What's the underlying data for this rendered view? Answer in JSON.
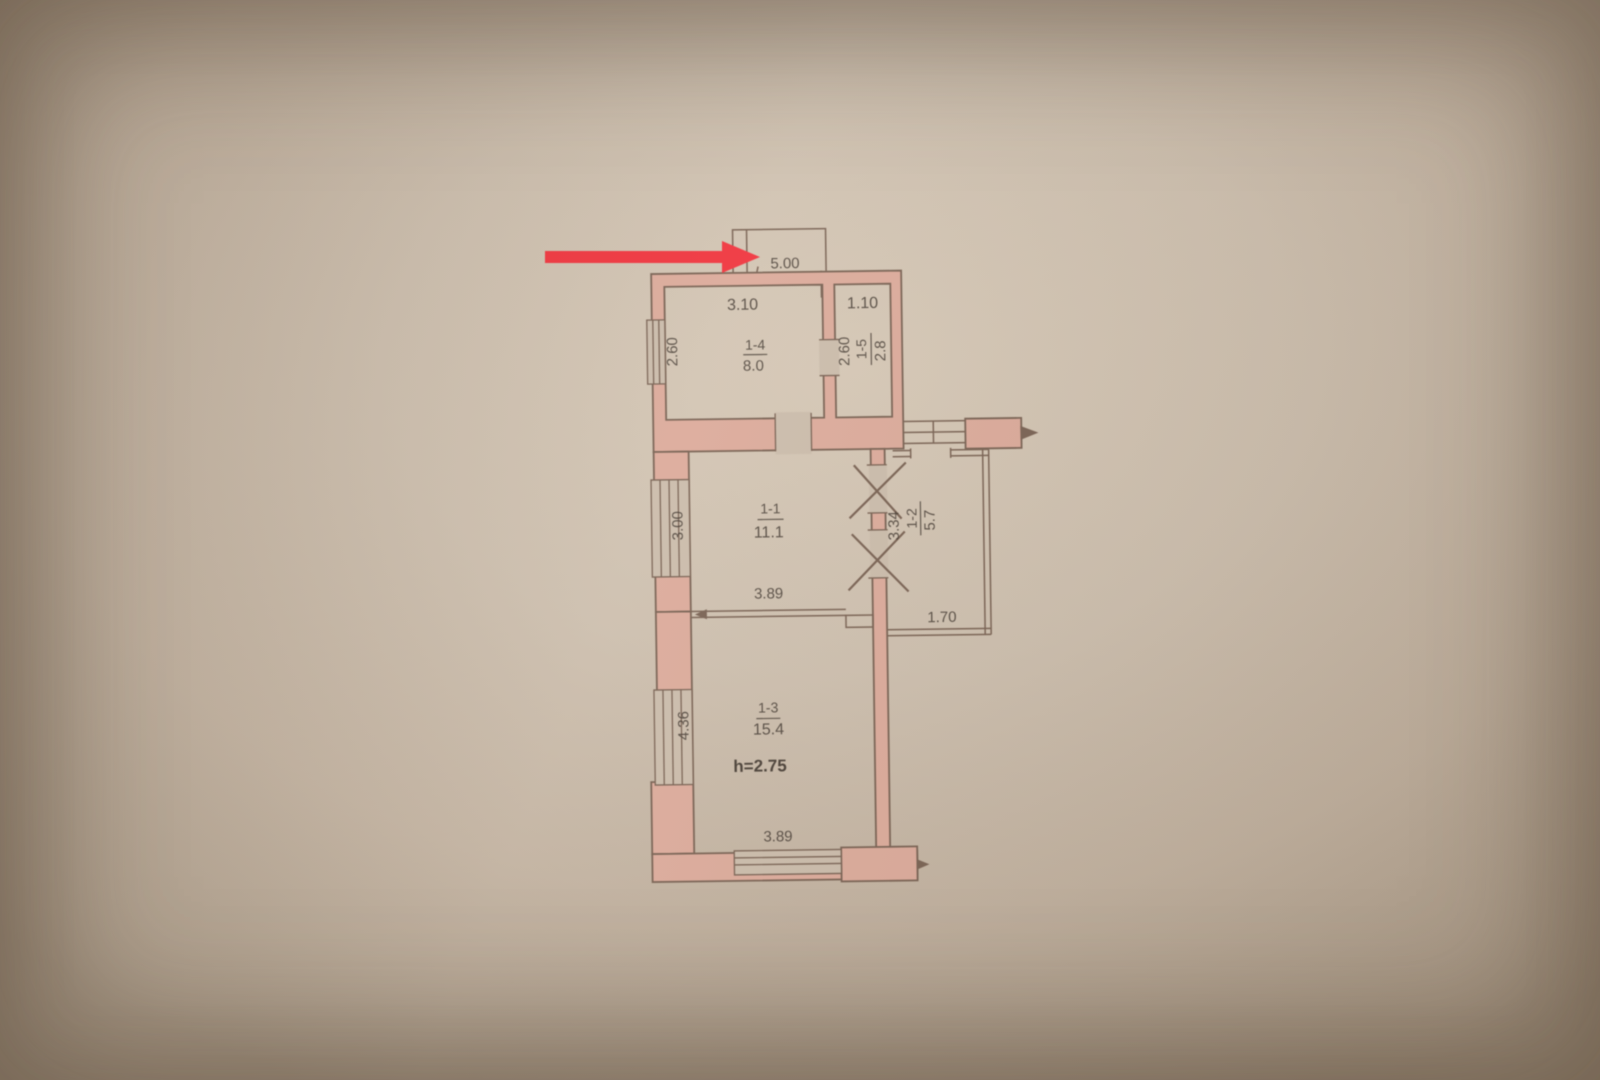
{
  "photo": {
    "description": "Scanned photo of an apartment floor plan on beige paper with a red annotation arrow",
    "paper_color": "#cbbcab"
  },
  "annotation": {
    "arrow_color": "#f0363f",
    "arrow_direction": "right"
  },
  "plan": {
    "balcony": {
      "dim": "5.00"
    },
    "rooms": {
      "r1": {
        "number": "1-1",
        "area": "11.1",
        "width": "3.89",
        "depth": "3.00"
      },
      "r2": {
        "number": "1-2",
        "area": "5.7",
        "width": "1.70",
        "depth": "3.34"
      },
      "r3": {
        "number": "1-3",
        "area": "15.4",
        "width": "3.89",
        "depth": "4.36",
        "ceiling": "h=2.75"
      },
      "r4": {
        "number": "1-4",
        "area": "8.0",
        "width": "3.10",
        "depth": "2.60"
      },
      "r5": {
        "number": "1-5",
        "area": "2.8",
        "width": "1.10",
        "depth": "2.60"
      }
    },
    "colors": {
      "wall_fill": "#dcab9b",
      "line": "#7a6354",
      "text": "#453b33",
      "height_text": "#5c60ad",
      "arrow": "#f0363f"
    }
  }
}
